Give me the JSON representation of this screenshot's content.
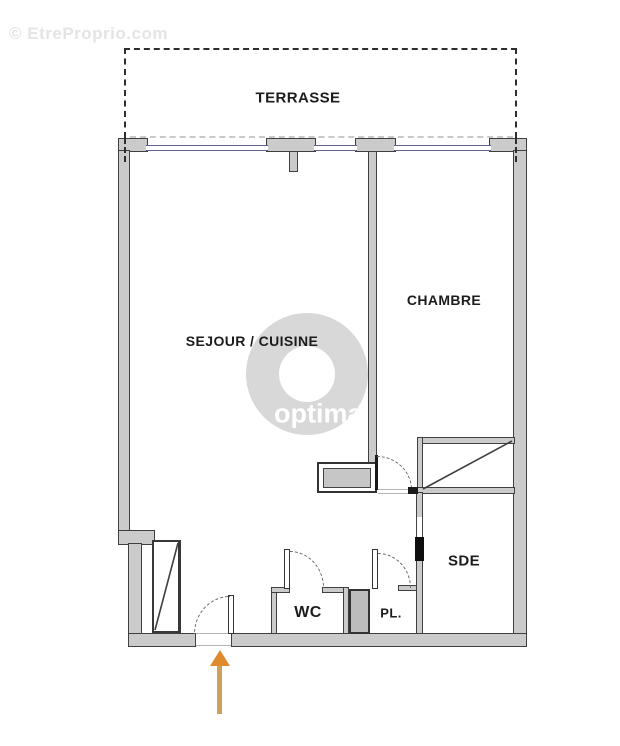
{
  "watermarks": {
    "site": "© EtreProprio.com",
    "logo_text": "optimal"
  },
  "floorplan": {
    "rooms": {
      "terrace": "TERRASSE",
      "living": "SEJOUR / CUISINE",
      "bedroom": "CHAMBRE",
      "wc": "WC",
      "closet": "PL.",
      "shower_room": "SDE"
    }
  },
  "colors": {
    "wall_fill": "#cbcbcb",
    "wall_outline": "#3f3f3f",
    "window_line": "#5d6286",
    "terrace_dash": "#2e2e2e",
    "watermark_ring": "#d8d8d8",
    "arrow_head": "#e08a2e",
    "arrow_shaft": "#cfa05c"
  }
}
